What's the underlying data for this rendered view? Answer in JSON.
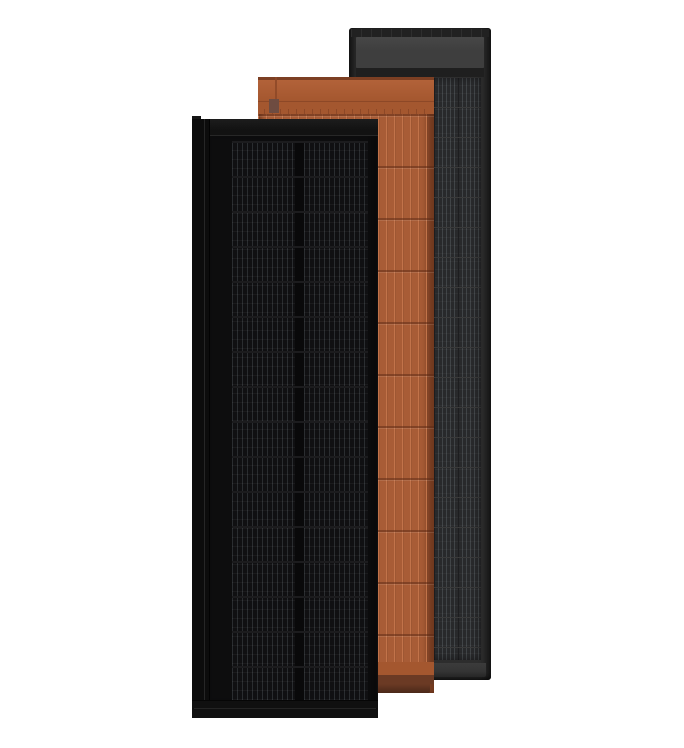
{
  "scene": {
    "type": "product-render",
    "subject": "three overlapping roof-integrated solar panels in black, terracotta and slate gray on a white background",
    "background_color": "#ffffff"
  },
  "panels": {
    "black": {
      "label": "black solar panel (front)",
      "body_color": "#0d0d0e",
      "cell_color": "#101012",
      "busbar_line_color": "#2a2d30",
      "cell_gap_color": "#09090a",
      "row_seam_color": "#1c1c1e"
    },
    "terracotta": {
      "label": "terracotta solar tile panel (middle)",
      "body_color": "#a85c36",
      "header_color": "#a4572f",
      "strip_line_color": "#c2734a",
      "seam_color": "#8d4827",
      "footer_band_color": "#6b3a24",
      "footer_edge_color": "#4a2819"
    },
    "slate": {
      "label": "slate gray solar panel (back)",
      "frame_color": "#2d2d2d",
      "top_bar_color": "#212121",
      "header_color": "#3e3e3e",
      "cell_color": "#28292b",
      "cell_line_color": "#404447",
      "column_separator_color": "#1d1d1f",
      "row_seam_color": "#3a3a3a",
      "bottom_bar_color": "#343434"
    }
  }
}
